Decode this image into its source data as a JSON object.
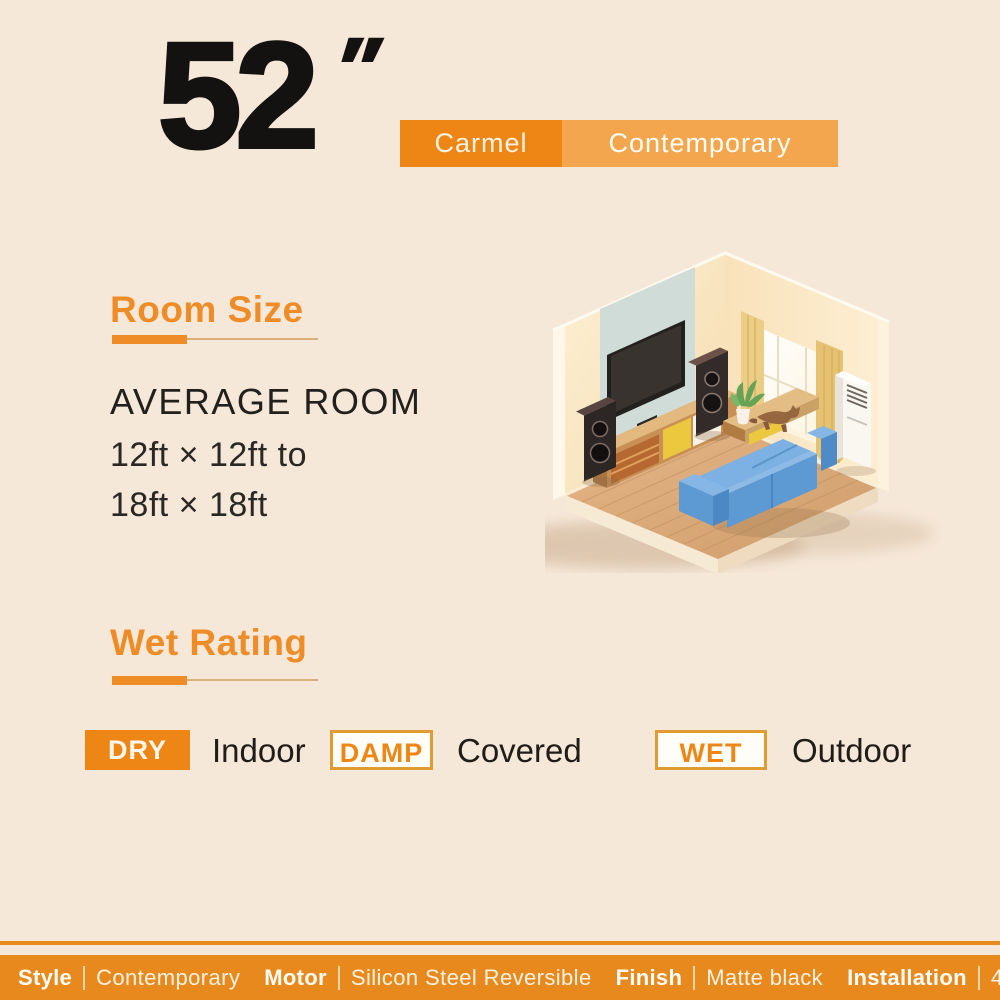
{
  "header": {
    "size_value": "52",
    "inch_mark": "″",
    "badge_primary": "Carmel",
    "badge_secondary": "Contemporary"
  },
  "room_size": {
    "title": "Room Size",
    "subtitle": "AVERAGE ROOM",
    "dimension_line1": "12ft × 12ft to",
    "dimension_line2": "18ft × 18ft"
  },
  "wet_rating": {
    "title": "Wet Rating",
    "items": [
      {
        "badge": "DRY",
        "label": "Indoor",
        "style": "solid"
      },
      {
        "badge": "DAMP",
        "label": "Covered",
        "style": "outline"
      },
      {
        "badge": "WET",
        "label": "Outdoor",
        "style": "outline"
      }
    ]
  },
  "illustration": {
    "name": "isometric-living-room",
    "objects": [
      "tv",
      "tv-console",
      "tower-speakers",
      "coffee-table",
      "side-table",
      "blue-sofa",
      "cat",
      "potted-plant",
      "floor-ac-unit",
      "window-with-curtains",
      "wood-floor"
    ]
  },
  "footer": {
    "specs": [
      {
        "label": "Style",
        "value": "Contemporary"
      },
      {
        "label": "Motor",
        "value": "Silicon Steel Reversible"
      },
      {
        "label": "Finish",
        "value": "Matte black"
      },
      {
        "label": "Installation",
        "value": "45-60 mins"
      }
    ]
  },
  "colors": {
    "background": "#f6e8d9",
    "accent_orange": "#ee8615",
    "light_orange": "#f3a64e",
    "heading_orange": "#ee8d28",
    "footer_orange": "#e8891e",
    "underline_tan": "#d9af7a",
    "text_dark": "#1f1c19",
    "sofa_blue": "#6ba3dc"
  }
}
